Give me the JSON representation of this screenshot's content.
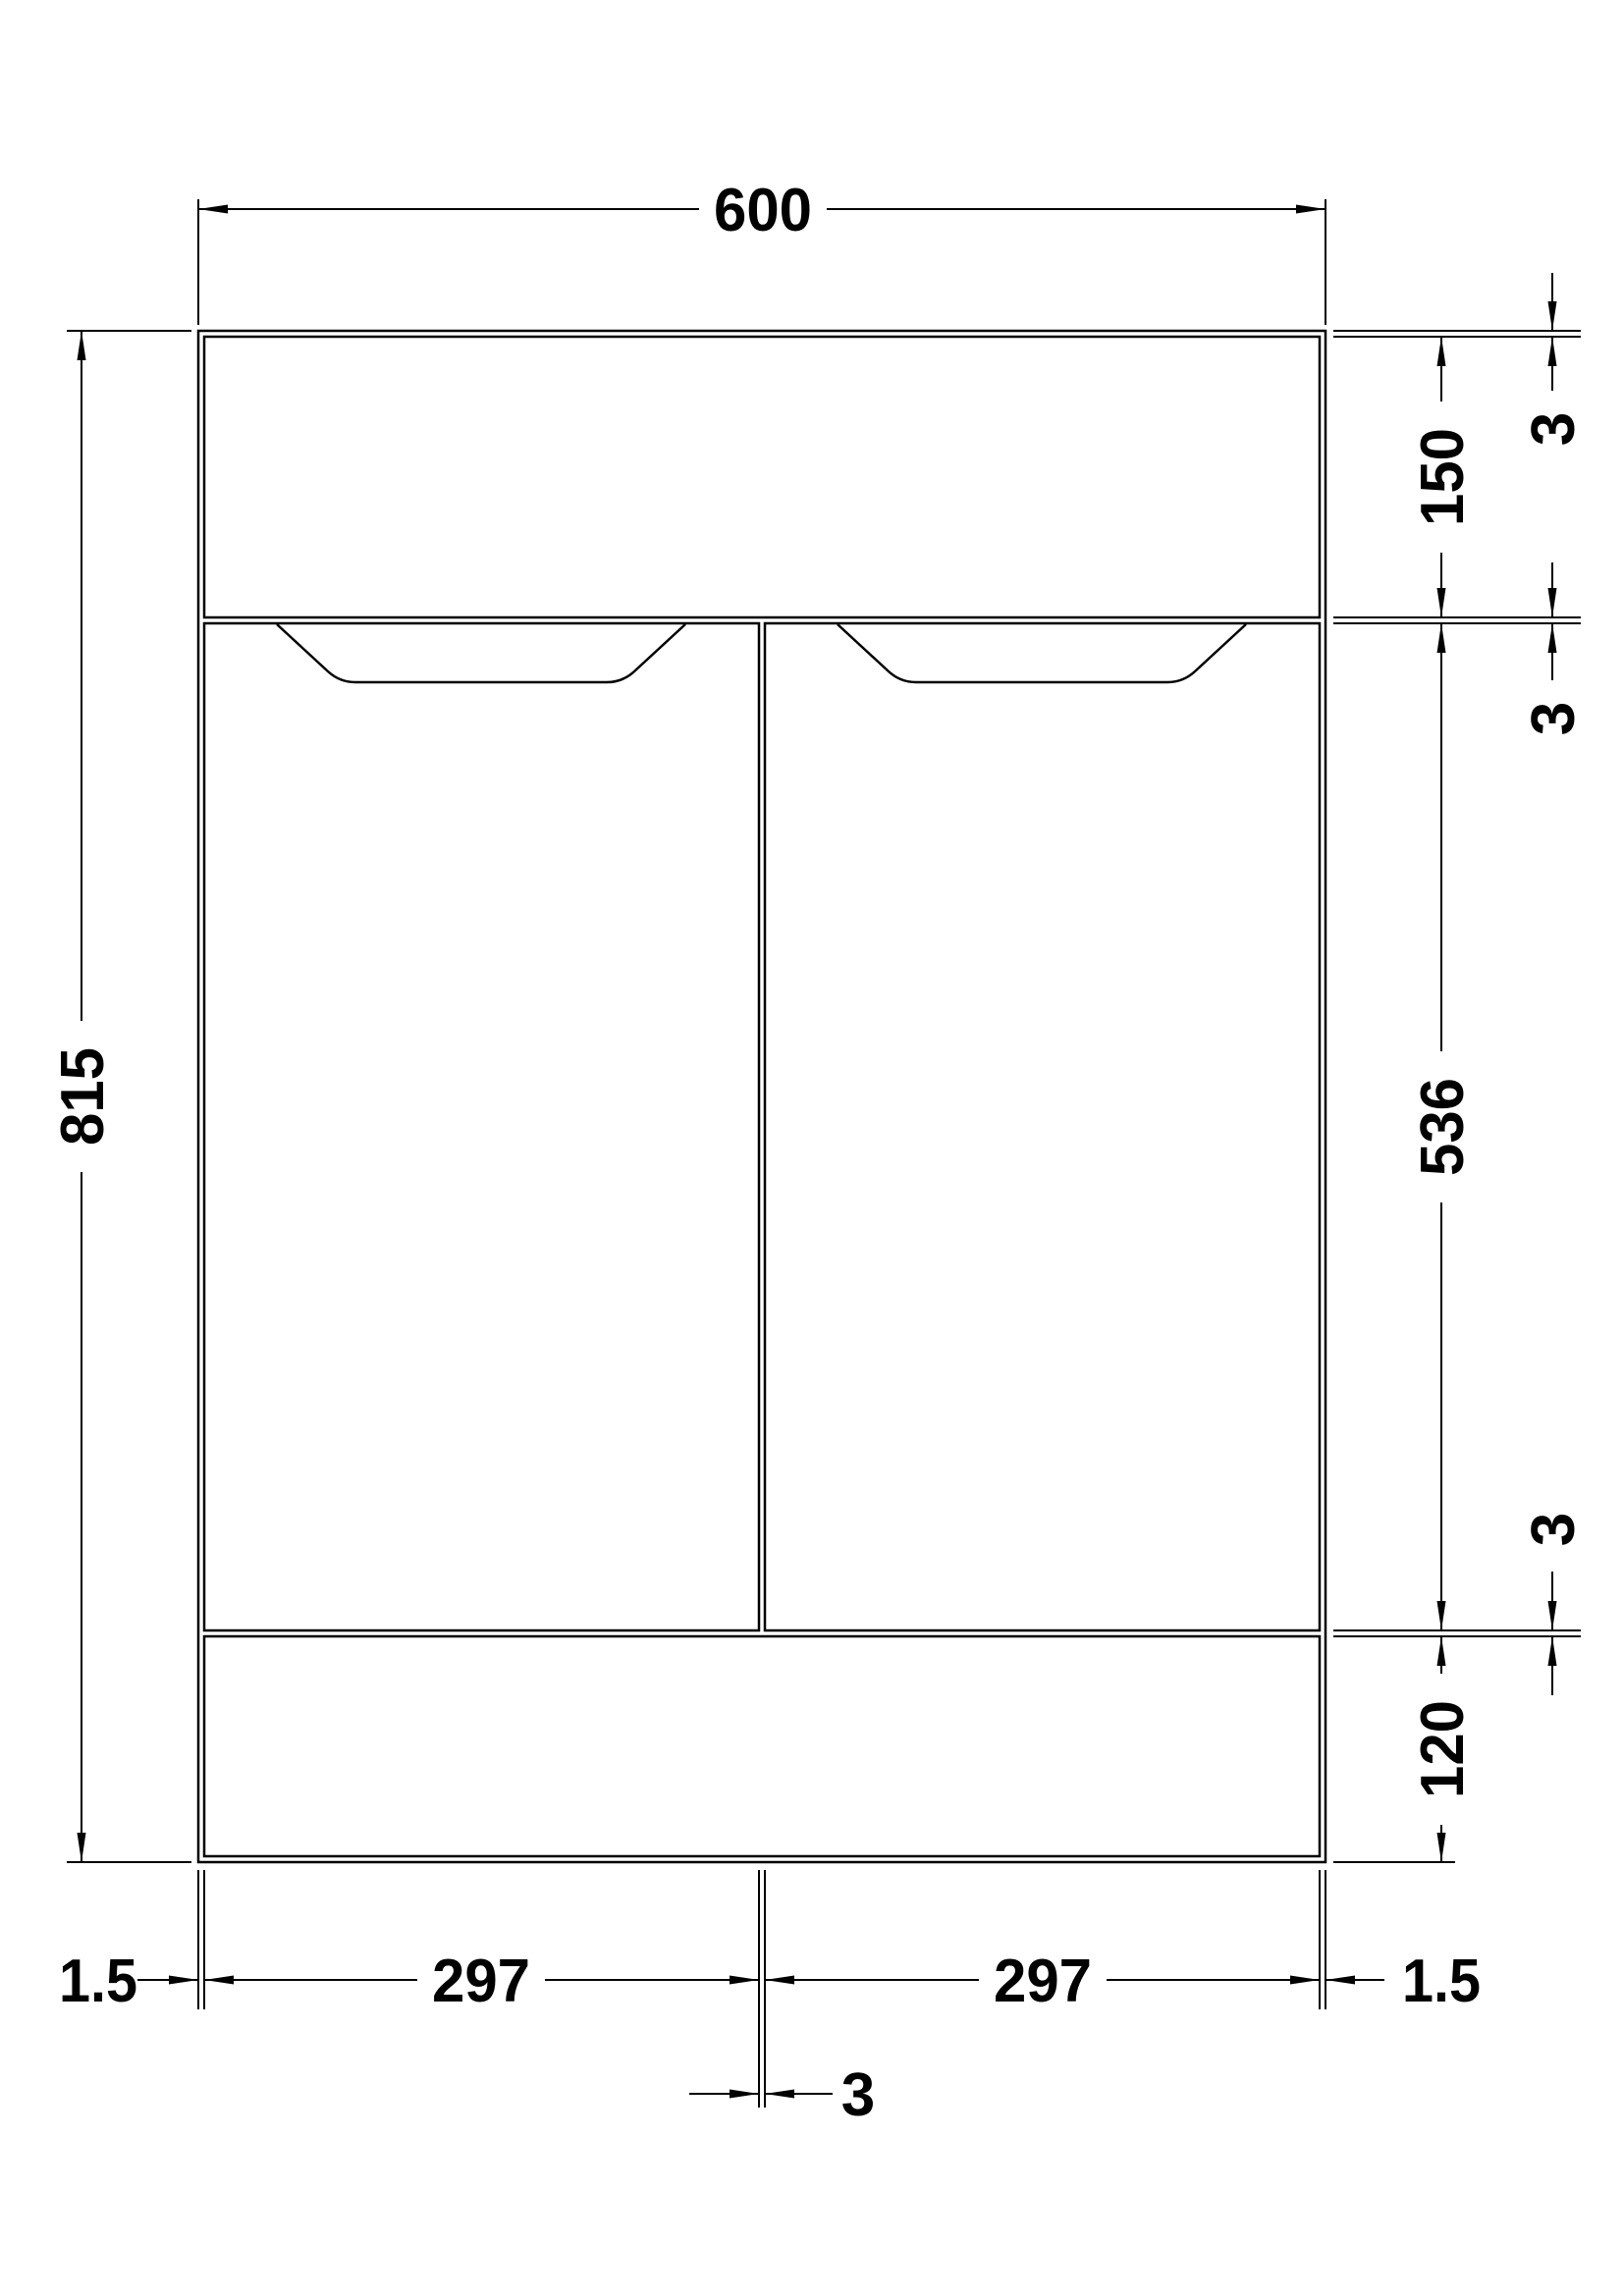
{
  "dimensions": {
    "overall_width": "600",
    "overall_height": "815",
    "top_panel_height": "150",
    "door_height": "536",
    "plinth_height": "120",
    "left_door_width": "297",
    "right_door_width": "297",
    "left_edge_offset": "1.5",
    "right_edge_offset": "1.5",
    "top_panel_gap": "3",
    "mid_rail_gap": "3",
    "bottom_rail_gap": "3",
    "centre_door_gap": "3"
  },
  "colors": {
    "line": "#000000",
    "background": "#ffffff"
  }
}
